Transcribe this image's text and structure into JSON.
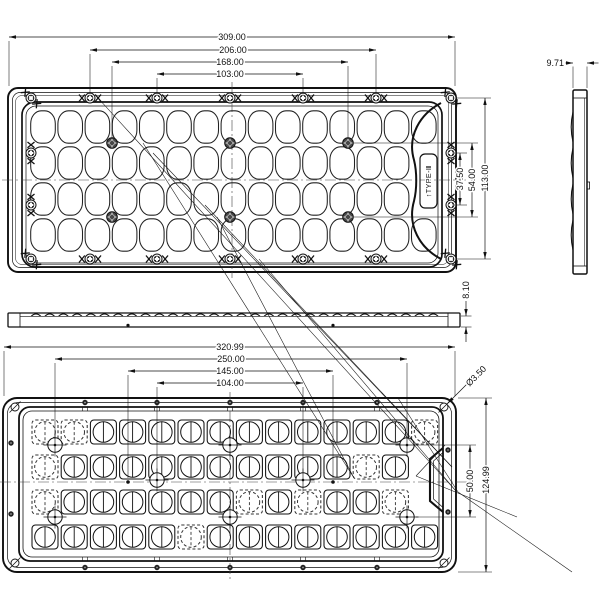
{
  "drawing": {
    "top_view": {
      "width_dims": [
        "309.00",
        "206.00",
        "168.00",
        "103.00"
      ],
      "height_dims": [
        "37.50",
        "54.00",
        "113.00"
      ],
      "type_label": "↑TYPE-Ⅲ",
      "lens_grid": {
        "rows": 4,
        "cols_outer_rows": 15,
        "cols_inner_rows": 14,
        "lens_shape": "oval"
      }
    },
    "side_view": {
      "thickness_dim": "9.71"
    },
    "profile_view": {
      "thickness_dim": "8.10"
    },
    "bottom_view": {
      "width_dims": [
        "320.99",
        "250.00",
        "145.00",
        "104.00"
      ],
      "side_dims": {
        "hole_dia": "Ø3.50",
        "inner_height": "50.00",
        "outer_height": "124.99"
      },
      "lens_grid": {
        "rows": 4,
        "cols_outer_rows": 14,
        "cols_inner_rows": 13,
        "lens_shape": "square-circle"
      },
      "dashed_cells": [
        [
          0,
          0
        ],
        [
          0,
          1
        ],
        [
          0,
          13
        ],
        [
          1,
          0
        ],
        [
          1,
          11
        ],
        [
          2,
          0
        ],
        [
          2,
          7
        ],
        [
          2,
          9
        ],
        [
          2,
          12
        ],
        [
          3,
          5
        ]
      ]
    }
  }
}
